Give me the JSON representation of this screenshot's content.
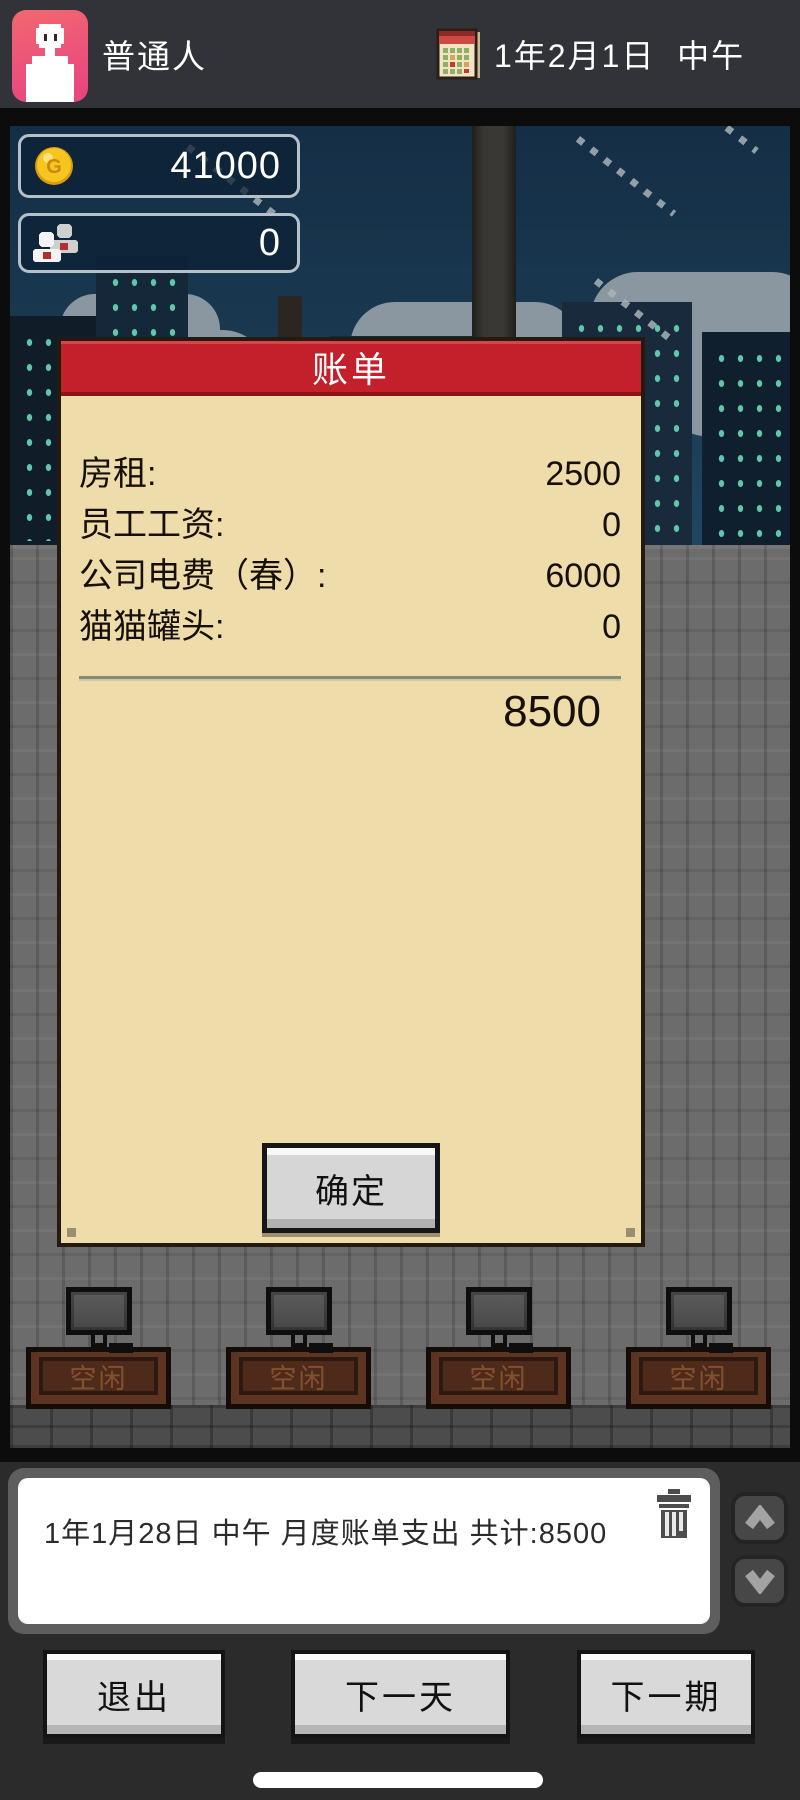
{
  "top_bar": {
    "player_title": "普通人",
    "date_text": "1年2月1日  中午"
  },
  "stats": {
    "gold": "41000",
    "staff": "0"
  },
  "bill_dialog": {
    "title": "账单",
    "items": [
      {
        "label": "房租:",
        "value": "2500"
      },
      {
        "label": "员工工资:",
        "value": "0"
      },
      {
        "label": "公司电费（春）:",
        "value": "6000"
      },
      {
        "label": "猫猫罐头:",
        "value": "0"
      }
    ],
    "total": "8500",
    "confirm_label": "确定"
  },
  "office": {
    "desks": [
      {
        "status": "空闲"
      },
      {
        "status": "空闲"
      },
      {
        "status": "空闲"
      },
      {
        "status": "空闲"
      }
    ]
  },
  "log_panel": {
    "entries": [
      {
        "text": "1年1月28日  中午  月度账单支出  共计:8500"
      }
    ]
  },
  "footer": {
    "exit_label": "退出",
    "next_day_label": "下一天",
    "next_period_label": "下一期"
  },
  "icons": {
    "coin_letter": "G",
    "avatar": "person-icon",
    "calendar": "calendar-icon",
    "gold": "coin-icon",
    "staff": "people-icon",
    "trash": "trash-icon",
    "scroll_up": "chevron-up-icon",
    "scroll_down": "chevron-down-icon"
  },
  "colors": {
    "accent_red": "#c3202b",
    "panel_cream": "#eedcab",
    "coin_gold": "#f2c21c",
    "avatar_pink": "#ec527b",
    "sky_blue": "#16324a",
    "wall_gray": "#6c6c6c"
  }
}
